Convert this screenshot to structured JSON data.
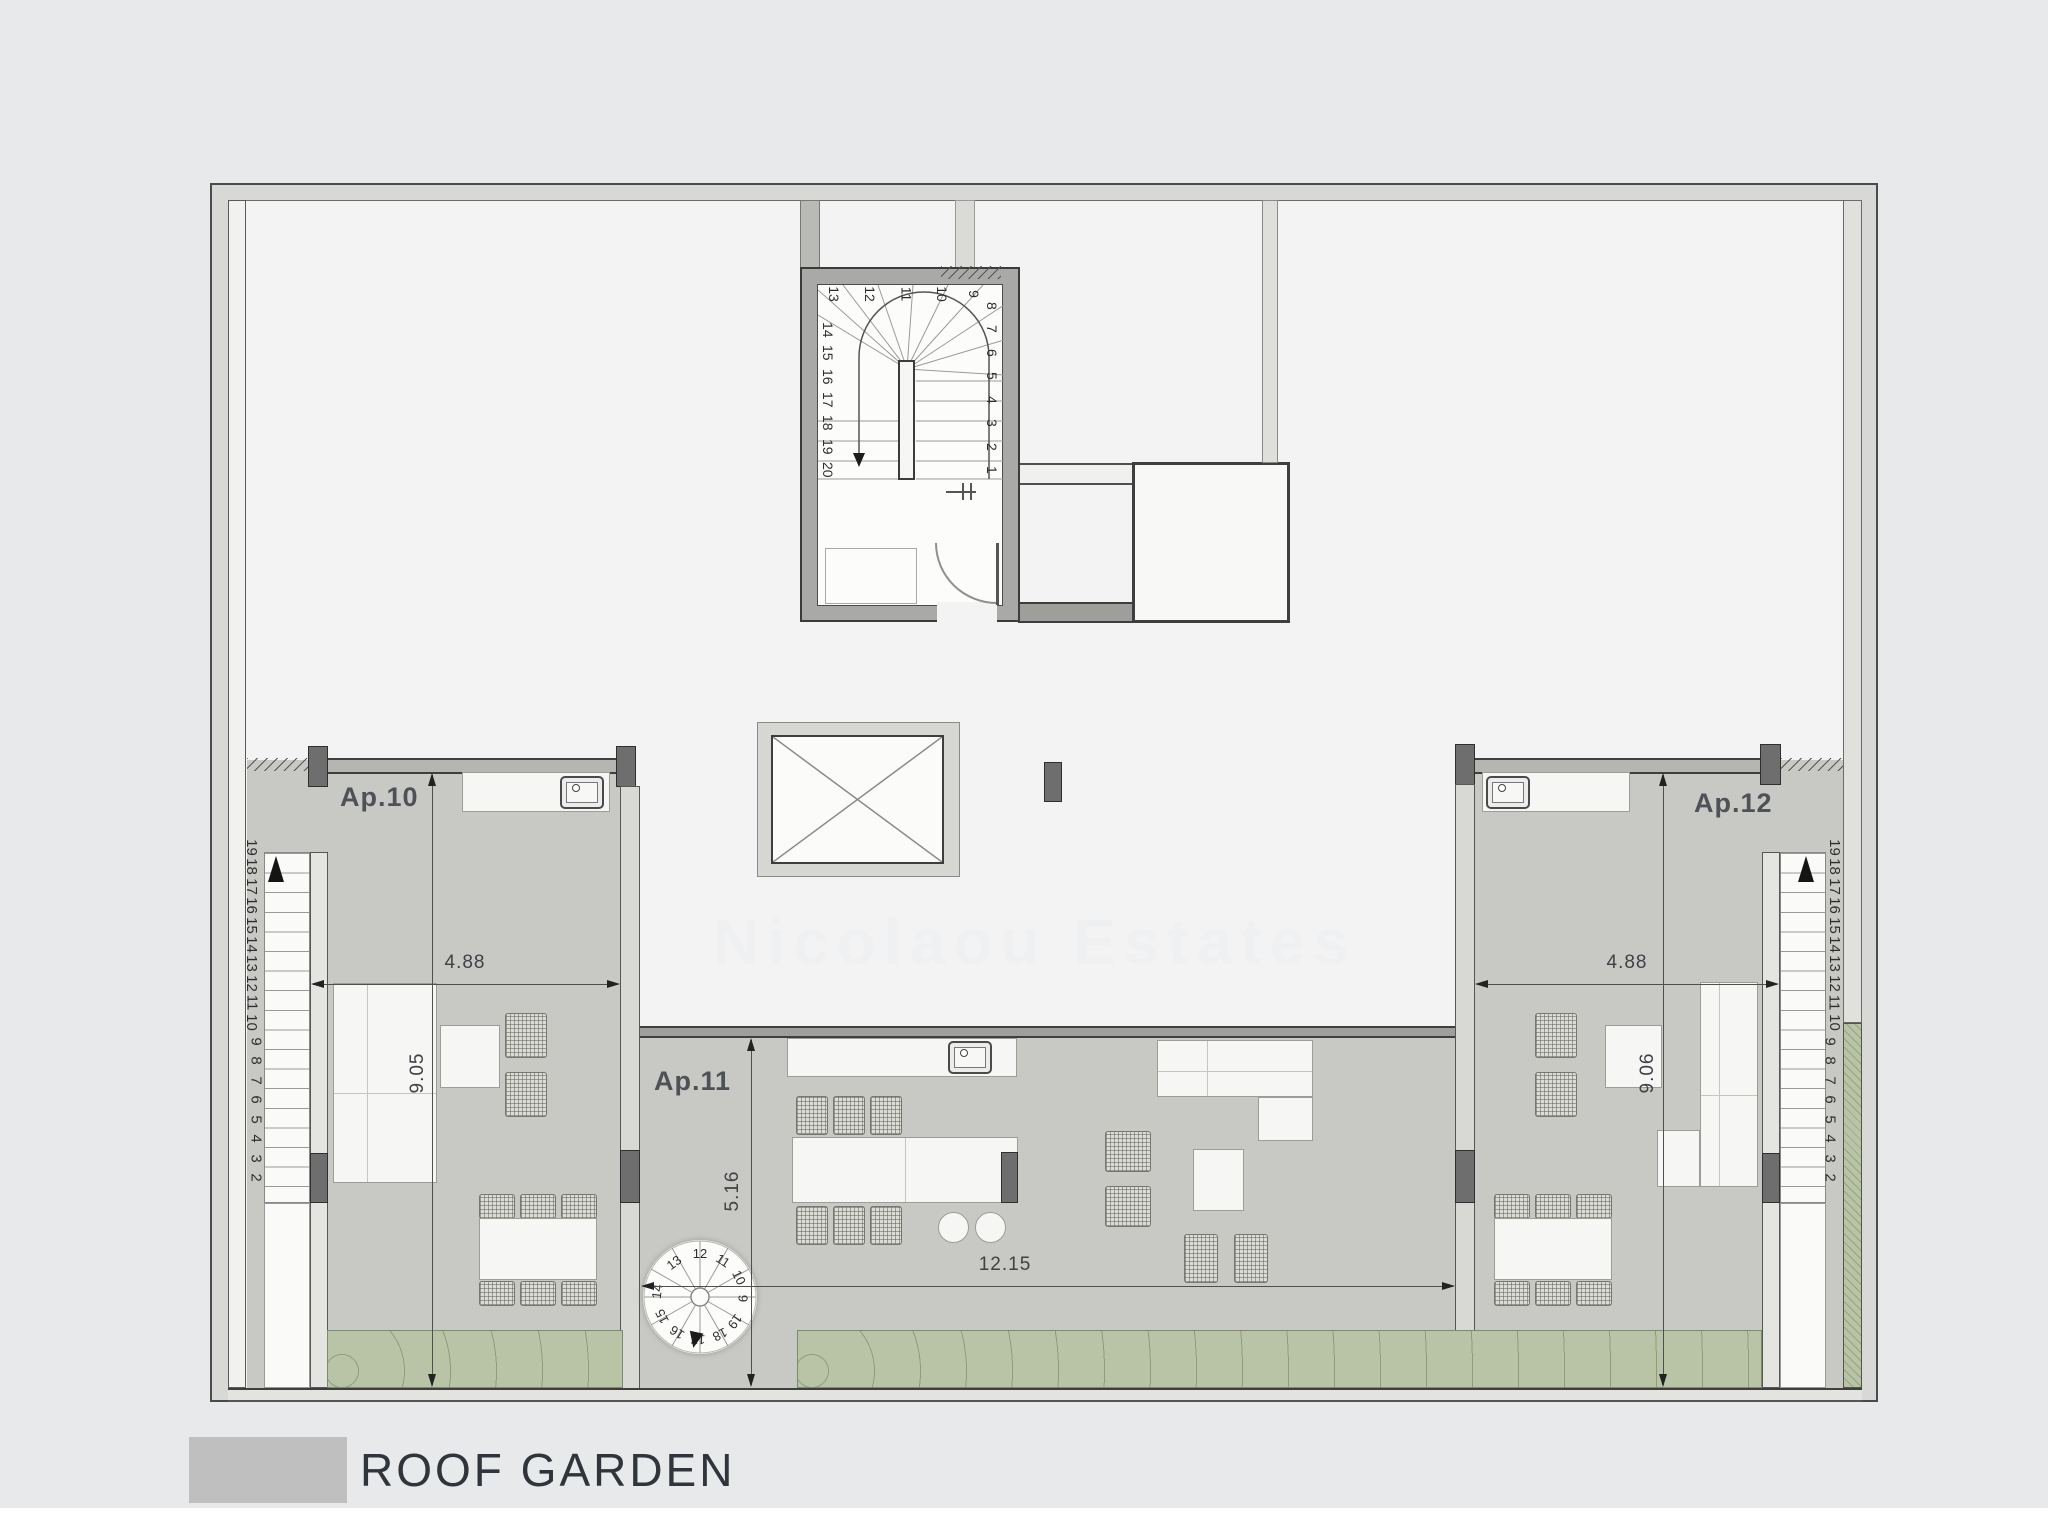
{
  "page": {
    "title": "ROOF GARDEN",
    "watermark": "Nicolaou Estates"
  },
  "apartments": {
    "ap10": {
      "label": "Ap.10",
      "width": "4.88",
      "depth": "9.05"
    },
    "ap11": {
      "label": "Ap.11",
      "width": "12.15",
      "depth": "5.16"
    },
    "ap12": {
      "label": "Ap.12",
      "width": "4.88",
      "depth": "9.06"
    }
  },
  "main_staircase": {
    "top_numbers": [
      "13",
      "12",
      "11",
      "10",
      "9"
    ],
    "right_numbers": [
      "8",
      "7",
      "6",
      "5",
      "4",
      "3",
      "2",
      "1"
    ],
    "left_numbers": [
      "14",
      "15",
      "16",
      "17",
      "18",
      "19",
      "20"
    ]
  },
  "side_staircase_numbers": [
    "19",
    "18",
    "17",
    "16",
    "15",
    "14",
    "13",
    "12",
    "11",
    "10",
    "9",
    "8",
    "7",
    "6",
    "5",
    "4",
    "3",
    "2"
  ],
  "spiral_staircase_numbers": [
    "12",
    "11",
    "10",
    "9",
    "19",
    "18",
    "17",
    "16",
    "15",
    "14",
    "13"
  ],
  "colors": {
    "background": "#e8e9ea",
    "roof": "#f3f3f4",
    "terrace": "#c8c9c4",
    "hedge": "#b9c4a6",
    "wall": "#a9a9a7",
    "swatch": "#bfbfbf"
  }
}
